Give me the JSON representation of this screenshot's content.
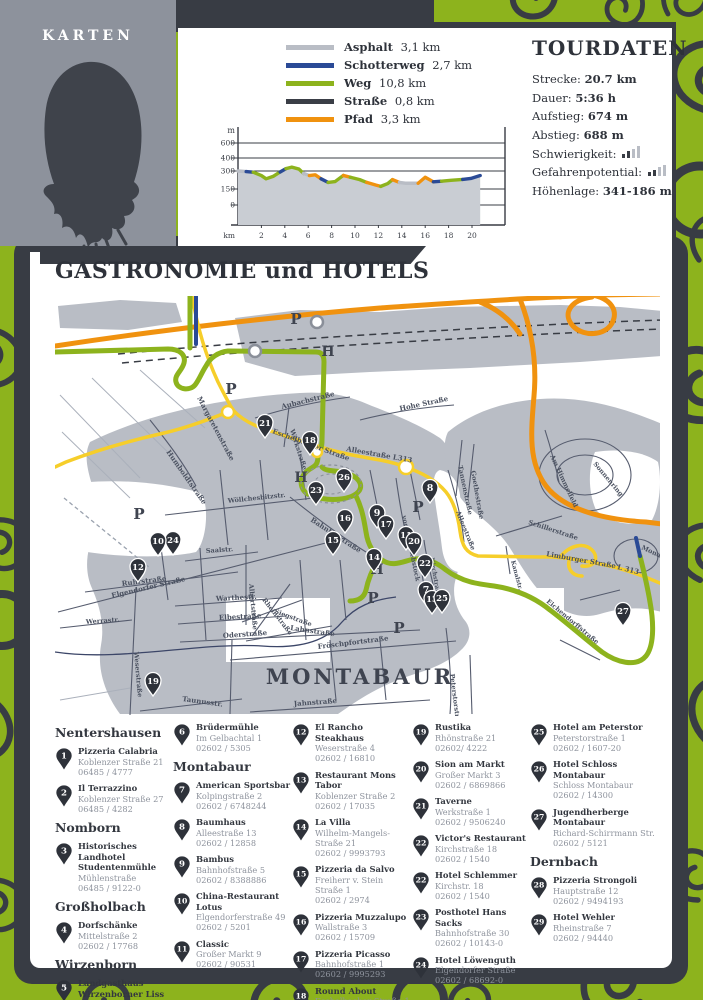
{
  "karten": {
    "title": "KARTEN"
  },
  "legend": {
    "items": [
      {
        "label": "Asphalt",
        "value": "3,1 km",
        "color": "#b9bdc5"
      },
      {
        "label": "Schotterweg",
        "value": "2,7 km",
        "color": "#2a4a96"
      },
      {
        "label": "Weg",
        "value": "10,8 km",
        "color": "#8db31d"
      },
      {
        "label": "Straße",
        "value": "0,8 km",
        "color": "#3a3e46"
      },
      {
        "label": "Pfad",
        "value": "3,3 km",
        "color": "#f0920f"
      }
    ]
  },
  "tourdaten": {
    "title": "TOURDATEN",
    "rows": [
      {
        "label": "Strecke:",
        "value": "20.7 km"
      },
      {
        "label": "Dauer:",
        "value": "5:36 h"
      },
      {
        "label": "Aufstieg:",
        "value": "674 m"
      },
      {
        "label": "Abstieg:",
        "value": "688 m"
      },
      {
        "label": "Schwierigkeit:",
        "value": "",
        "bars_filled": 2,
        "bars_total": 4
      },
      {
        "label": "Gefahrenpotential:",
        "value": "",
        "bars_filled": 2,
        "bars_total": 4
      },
      {
        "label": "Höhenlage:",
        "value": "341-186 m"
      }
    ]
  },
  "chart_data": {
    "type": "area",
    "ylabel": "m",
    "xlabel": "km",
    "yticks": [
      0,
      150,
      300,
      400,
      600
    ],
    "xticks": [
      2,
      4,
      6,
      8,
      10,
      12,
      14,
      16,
      18,
      20
    ],
    "xrange": [
      0,
      20.7
    ],
    "km_bars": [
      [
        2,
        4
      ],
      [
        6,
        8
      ],
      [
        10,
        12
      ],
      [
        14,
        16
      ],
      [
        18,
        20
      ]
    ],
    "surface_colors": {
      "Asphalt": "#b9bdc5",
      "Schotterweg": "#2a4a96",
      "Weg": "#8db31d",
      "Straße": "#3a3e46",
      "Pfad": "#f0920f"
    },
    "profile": [
      {
        "surface": "Asphalt",
        "points": [
          [
            0,
            300
          ],
          [
            0.7,
            295
          ]
        ]
      },
      {
        "surface": "Schotterweg",
        "points": [
          [
            0.7,
            295
          ],
          [
            1.3,
            290
          ]
        ]
      },
      {
        "surface": "Weg",
        "points": [
          [
            1.3,
            290
          ],
          [
            2.0,
            262
          ],
          [
            2.4,
            235
          ],
          [
            3.0,
            255
          ],
          [
            3.6,
            292
          ]
        ]
      },
      {
        "surface": "Schotterweg",
        "points": [
          [
            3.6,
            292
          ],
          [
            4.1,
            318
          ]
        ]
      },
      {
        "surface": "Weg",
        "points": [
          [
            4.1,
            318
          ],
          [
            4.6,
            330
          ],
          [
            5.2,
            315
          ],
          [
            5.6,
            280
          ]
        ]
      },
      {
        "surface": "Asphalt",
        "points": [
          [
            5.6,
            280
          ],
          [
            6.1,
            262
          ]
        ]
      },
      {
        "surface": "Pfad",
        "points": [
          [
            6.1,
            262
          ],
          [
            6.6,
            268
          ],
          [
            7.1,
            235
          ]
        ]
      },
      {
        "surface": "Schotterweg",
        "points": [
          [
            7.1,
            235
          ],
          [
            7.7,
            205
          ]
        ]
      },
      {
        "surface": "Weg",
        "points": [
          [
            7.7,
            205
          ],
          [
            8.3,
            212
          ],
          [
            9.0,
            263
          ]
        ]
      },
      {
        "surface": "Pfad",
        "points": [
          [
            9.0,
            263
          ],
          [
            9.6,
            248
          ]
        ]
      },
      {
        "surface": "Weg",
        "points": [
          [
            9.6,
            248
          ],
          [
            10.4,
            228
          ],
          [
            11.0,
            205
          ]
        ]
      },
      {
        "surface": "Pfad",
        "points": [
          [
            11.0,
            205
          ],
          [
            11.8,
            182
          ],
          [
            12.2,
            172
          ]
        ]
      },
      {
        "surface": "Weg",
        "points": [
          [
            12.2,
            172
          ],
          [
            12.8,
            195
          ],
          [
            13.2,
            228
          ]
        ]
      },
      {
        "surface": "Pfad",
        "points": [
          [
            13.2,
            228
          ],
          [
            13.8,
            205
          ]
        ]
      },
      {
        "surface": "Asphalt",
        "points": [
          [
            13.8,
            205
          ],
          [
            14.3,
            198
          ],
          [
            15.4,
            198
          ]
        ]
      },
      {
        "surface": "Pfad",
        "points": [
          [
            15.4,
            198
          ],
          [
            16.0,
            248
          ],
          [
            16.7,
            210
          ]
        ]
      },
      {
        "surface": "Schotterweg",
        "points": [
          [
            16.7,
            210
          ],
          [
            17.4,
            215
          ]
        ]
      },
      {
        "surface": "Weg",
        "points": [
          [
            17.4,
            215
          ],
          [
            18.2,
            222
          ],
          [
            19.2,
            230
          ]
        ]
      },
      {
        "surface": "Schotterweg",
        "points": [
          [
            19.2,
            230
          ],
          [
            19.9,
            238
          ],
          [
            20.7,
            262
          ]
        ]
      }
    ]
  },
  "section_title": "GASTRONOMIE und HOTELS",
  "map": {
    "city_label": "MONTABAUR",
    "parking_letter": "P",
    "hotel_letter": "H",
    "markers": [
      {
        "n": "21",
        "x": 265,
        "y": 424
      },
      {
        "n": "18",
        "x": 310,
        "y": 441
      },
      {
        "n": "26",
        "x": 344,
        "y": 478
      },
      {
        "n": "23",
        "x": 316,
        "y": 491
      },
      {
        "n": "8",
        "x": 430,
        "y": 489
      },
      {
        "n": "16",
        "x": 345,
        "y": 519
      },
      {
        "n": "15",
        "x": 333,
        "y": 541
      },
      {
        "n": "9",
        "x": 377,
        "y": 514
      },
      {
        "n": "17",
        "x": 386,
        "y": 525
      },
      {
        "n": "14",
        "x": 374,
        "y": 558
      },
      {
        "n": "11",
        "x": 406,
        "y": 536
      },
      {
        "n": "20",
        "x": 414,
        "y": 542
      },
      {
        "n": "22",
        "x": 425,
        "y": 564
      },
      {
        "n": "24",
        "x": 173,
        "y": 541
      },
      {
        "n": "10",
        "x": 158,
        "y": 542
      },
      {
        "n": "12",
        "x": 138,
        "y": 568
      },
      {
        "n": "7",
        "x": 426,
        "y": 591
      },
      {
        "n": "13",
        "x": 432,
        "y": 600
      },
      {
        "n": "25",
        "x": 442,
        "y": 599
      },
      {
        "n": "19",
        "x": 153,
        "y": 682
      },
      {
        "n": "27",
        "x": 623,
        "y": 612
      }
    ],
    "parking": [
      {
        "x": 296,
        "y": 324
      },
      {
        "x": 231,
        "y": 394
      },
      {
        "x": 139,
        "y": 519
      },
      {
        "x": 418,
        "y": 512
      },
      {
        "x": 373,
        "y": 603
      },
      {
        "x": 399,
        "y": 633
      }
    ],
    "hotels": [
      {
        "x": 328,
        "y": 356
      },
      {
        "x": 301,
        "y": 482
      },
      {
        "x": 377,
        "y": 574
      }
    ],
    "street_labels": [
      {
        "text": "Margaretenstraße",
        "x": 197,
        "y": 398,
        "rot": 62,
        "size": 7
      },
      {
        "text": "Aubachstraße",
        "x": 282,
        "y": 409,
        "rot": -14,
        "size": 7
      },
      {
        "text": "Werkstraße",
        "x": 290,
        "y": 430,
        "rot": 72,
        "size": 6.5
      },
      {
        "text": "Hohe Straße",
        "x": 400,
        "y": 411,
        "rot": -12,
        "size": 7
      },
      {
        "text": "Eschelbacher Straße",
        "x": 272,
        "y": 433,
        "rot": 20,
        "size": 7
      },
      {
        "text": "Alleestraße L313",
        "x": 346,
        "y": 451,
        "rot": 10,
        "size": 7
      },
      {
        "text": "Humboldtstraße",
        "x": 166,
        "y": 452,
        "rot": 55,
        "size": 7
      },
      {
        "text": "Wöllchesbitzstr.",
        "x": 228,
        "y": 503,
        "rot": -6,
        "size": 6.5
      },
      {
        "text": "Bahnhofstraße",
        "x": 310,
        "y": 521,
        "rot": 33,
        "size": 7
      },
      {
        "text": "vorderer Rebstock",
        "x": 402,
        "y": 516,
        "rot": 78,
        "size": 6.5
      },
      {
        "text": "Alleestraße",
        "x": 456,
        "y": 512,
        "rot": 68,
        "size": 6.5
      },
      {
        "text": "Kirchstraße",
        "x": 430,
        "y": 558,
        "rot": 80,
        "size": 6
      },
      {
        "text": "Elgendorfer Straße",
        "x": 112,
        "y": 598,
        "rot": -13,
        "size": 7
      },
      {
        "text": "Saalstr.",
        "x": 206,
        "y": 553,
        "rot": -4,
        "size": 6.5
      },
      {
        "text": "Ruhrstraße",
        "x": 122,
        "y": 586,
        "rot": -7,
        "size": 7
      },
      {
        "text": "Weserstraße",
        "x": 134,
        "y": 652,
        "rot": 85,
        "size": 6.5
      },
      {
        "text": "Werrastr.",
        "x": 86,
        "y": 624,
        "rot": -4,
        "size": 6.5
      },
      {
        "text": "Warthestr.",
        "x": 216,
        "y": 601,
        "rot": -3,
        "size": 7
      },
      {
        "text": "Elbestraße",
        "x": 219,
        "y": 620,
        "rot": -3,
        "size": 7
      },
      {
        "text": "Oderstraße",
        "x": 223,
        "y": 638,
        "rot": -4,
        "size": 7
      },
      {
        "text": "Albertstraße",
        "x": 249,
        "y": 584,
        "rot": 85,
        "size": 6.5
      },
      {
        "text": "Rheinstraße",
        "x": 262,
        "y": 600,
        "rot": 52,
        "size": 6.5
      },
      {
        "text": "Siegstraße",
        "x": 274,
        "y": 613,
        "rot": 20,
        "size": 6.5
      },
      {
        "text": "Lahnstraße",
        "x": 290,
        "y": 630,
        "rot": 8,
        "size": 7
      },
      {
        "text": "Fröschpfortstraße",
        "x": 318,
        "y": 649,
        "rot": -7,
        "size": 7
      },
      {
        "text": "Jahnstraße",
        "x": 294,
        "y": 706,
        "rot": -4,
        "size": 7
      },
      {
        "text": "Taunusstr.",
        "x": 182,
        "y": 701,
        "rot": 8,
        "size": 7
      },
      {
        "text": "Peterstorstraße",
        "x": 450,
        "y": 674,
        "rot": 83,
        "size": 6.5
      },
      {
        "text": "Goethestraße",
        "x": 471,
        "y": 471,
        "rot": 80,
        "size": 6.5
      },
      {
        "text": "Tannenstraße",
        "x": 458,
        "y": 466,
        "rot": 78,
        "size": 6.5
      },
      {
        "text": "Am Himmelfeld",
        "x": 550,
        "y": 456,
        "rot": 65,
        "size": 6.5
      },
      {
        "text": "Sonnenring",
        "x": 593,
        "y": 464,
        "rot": 50,
        "size": 6.5
      },
      {
        "text": "Schillerstraße",
        "x": 528,
        "y": 524,
        "rot": 18,
        "size": 6.5
      },
      {
        "text": "Limburger Straße",
        "x": 546,
        "y": 556,
        "rot": 10,
        "size": 7
      },
      {
        "text": "L 313",
        "x": 617,
        "y": 569,
        "rot": 14,
        "size": 7
      },
      {
        "text": "Kanalstr.",
        "x": 511,
        "y": 561,
        "rot": 75,
        "size": 6
      },
      {
        "text": "Eichendorffstraße",
        "x": 546,
        "y": 602,
        "rot": 40,
        "size": 6.5
      },
      {
        "text": "Mondring",
        "x": 641,
        "y": 549,
        "rot": 25,
        "size": 6.5
      }
    ]
  },
  "directory": {
    "columns": [
      [
        {
          "type": "header",
          "text": "Nentershausen"
        },
        {
          "type": "entry",
          "n": "1",
          "name": "Pizzeria Calabria",
          "lines": [
            "Koblenzer Straße 21",
            "06485 / 4777"
          ]
        },
        {
          "type": "entry",
          "n": "2",
          "name": "Il Terrazzino",
          "lines": [
            "Koblenzer Straße 27",
            "06485 / 4282"
          ]
        },
        {
          "type": "header",
          "text": "Nomborn"
        },
        {
          "type": "entry",
          "n": "3",
          "name": "Historisches Landhotel Studentenmühle",
          "lines": [
            "Mühlenstraße",
            "06485 / 9122-0"
          ]
        },
        {
          "type": "header",
          "text": "Großholbach"
        },
        {
          "type": "entry",
          "n": "4",
          "name": "Dorfschänke",
          "lines": [
            "Mittelstraße 2",
            "02602 / 17768"
          ]
        },
        {
          "type": "header",
          "text": "Wirzenborn"
        },
        {
          "type": "entry",
          "n": "5",
          "name": "Landgasthaus Wirzenborner Liss",
          "lines": [
            "Kapellenstraße 18",
            "02602 / 4327"
          ]
        }
      ],
      [
        {
          "type": "entry",
          "n": "6",
          "name": "Brüdermühle",
          "lines": [
            "Im Gelbachtal 1",
            "02602 / 5305"
          ]
        },
        {
          "type": "header",
          "text": "Montabaur"
        },
        {
          "type": "entry",
          "n": "7",
          "name": "American Sportsbar",
          "lines": [
            "Kolpingstraße 2",
            "02602 / 6748244"
          ]
        },
        {
          "type": "entry",
          "n": "8",
          "name": "Baumhaus",
          "lines": [
            "Alleestraße 13",
            "02602 / 12858"
          ]
        },
        {
          "type": "entry",
          "n": "9",
          "name": "Bambus",
          "lines": [
            "Bahnhofstraße 5",
            "02602 / 8388886"
          ]
        },
        {
          "type": "entry",
          "n": "10",
          "name": "China-Restaurant Lotus",
          "lines": [
            "Elgendorferstraße 49",
            "02602 / 5201"
          ]
        },
        {
          "type": "entry",
          "n": "11",
          "name": "Classic",
          "lines": [
            "Großer Markt 9",
            "02602 / 90531"
          ]
        }
      ],
      [
        {
          "type": "entry",
          "n": "12",
          "name": "El Rancho Steakhaus",
          "lines": [
            "Weserstraße 4",
            "02602 / 16810"
          ]
        },
        {
          "type": "entry",
          "n": "13",
          "name": "Restaurant Mons Tabor",
          "lines": [
            "Koblenzer Straße 2",
            "02602 / 17035"
          ]
        },
        {
          "type": "entry",
          "n": "14",
          "name": "La Villa",
          "lines": [
            "Wilhelm-Mangels-Straße 21",
            "02602 / 9993793"
          ]
        },
        {
          "type": "entry",
          "n": "15",
          "name": "Pizzeria da Salvo",
          "lines": [
            "Freiherr v. Stein Straße 1",
            "02602 / 2974"
          ]
        },
        {
          "type": "entry",
          "n": "16",
          "name": "Pizzeria Muzzalupo",
          "lines": [
            "Wallstraße 3",
            "02602 / 15709"
          ]
        },
        {
          "type": "entry",
          "n": "17",
          "name": "Pizzeria Picasso",
          "lines": [
            "Bahnhofstraße 1",
            "02602 / 9995293"
          ]
        },
        {
          "type": "entry",
          "n": "18",
          "name": "Round About",
          "lines": [
            "Eschelbacher Straße 1",
            "02602 / 9979001"
          ]
        }
      ],
      [
        {
          "type": "entry",
          "n": "19",
          "name": "Rustika",
          "lines": [
            "Rhönstraße 21",
            "02602/ 4222"
          ]
        },
        {
          "type": "entry",
          "n": "20",
          "name": "Sion am Markt",
          "lines": [
            "Großer Markt 3",
            "02602 / 6869866"
          ]
        },
        {
          "type": "entry",
          "n": "21",
          "name": "Taverne",
          "lines": [
            "Werkstraße 1",
            "02602 / 9506240"
          ]
        },
        {
          "type": "entry",
          "n": "22",
          "name": "Victor's Restaurant",
          "lines": [
            "Kirchstraße 18",
            "02602 / 1540"
          ]
        },
        {
          "type": "entry",
          "n": "22",
          "name": "Hotel Schlemmer",
          "lines": [
            "Kirchstr. 18",
            "02602 / 1540"
          ]
        },
        {
          "type": "entry",
          "n": "23",
          "name": "Posthotel Hans Sacks",
          "lines": [
            "Bahnhofstraße 30",
            "02602 / 10143-0"
          ]
        },
        {
          "type": "entry",
          "n": "24",
          "name": "Hotel Löwenguth",
          "lines": [
            "Elgendorfer Straße",
            "02602 / 68692-0"
          ]
        }
      ],
      [
        {
          "type": "entry",
          "n": "25",
          "name": "Hotel am Peterstor",
          "lines": [
            "Peterstorstraße 1",
            "02602 / 1607-20"
          ]
        },
        {
          "type": "entry",
          "n": "26",
          "name": "Hotel Schloss Montabaur",
          "lines": [
            "Schloss Montabaur",
            "02602 / 14300"
          ]
        },
        {
          "type": "entry",
          "n": "27",
          "name": "Jugendherberge Montabaur",
          "lines": [
            "Richard-Schirrmann Str.",
            "02602 / 5121"
          ]
        },
        {
          "type": "header",
          "text": "Dernbach"
        },
        {
          "type": "entry",
          "n": "28",
          "name": "Pizzeria Strongoli",
          "lines": [
            "Hauptstraße 12",
            "02602 / 9494193"
          ]
        },
        {
          "type": "entry",
          "n": "29",
          "name": "Hotel Wehler",
          "lines": [
            "Rheinstraße 7",
            "02602 / 94440"
          ]
        }
      ]
    ]
  }
}
